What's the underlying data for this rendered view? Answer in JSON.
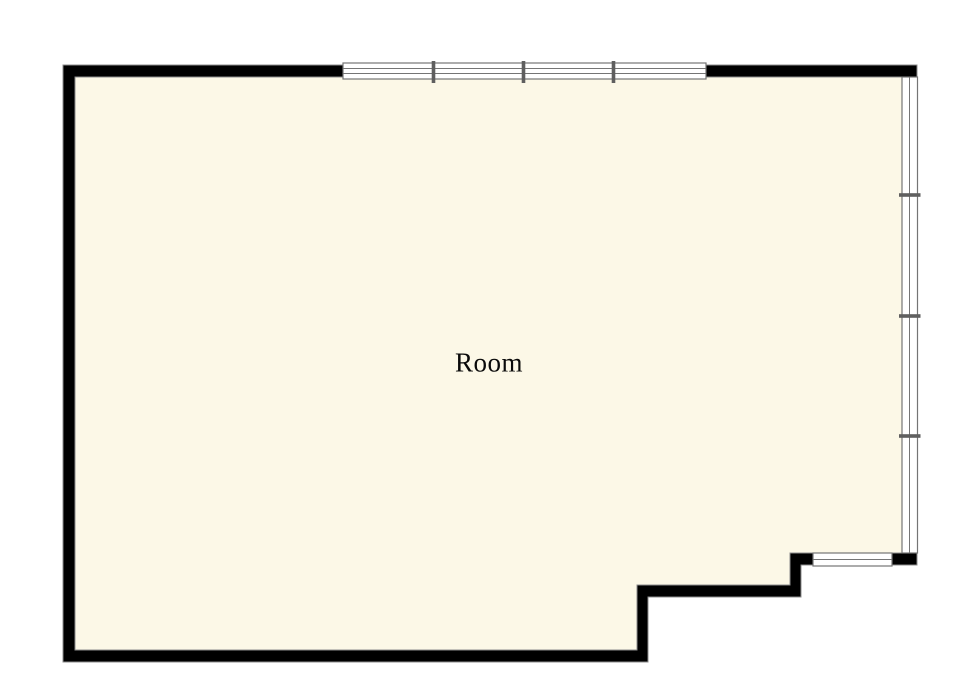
{
  "floorplan": {
    "room_label": "Room",
    "colors": {
      "background": "#ffffff",
      "floor": "#fcf8e7",
      "wall": "#000000",
      "wall_outline": "#8c8c8c",
      "window_fill": "#ffffff",
      "window_frame": "#757575",
      "window_mullion": "#5f5f5f",
      "label_text": "#0a0a0a"
    },
    "windows": [
      {
        "name": "top-window",
        "orientation": "horizontal",
        "panes": 4
      },
      {
        "name": "right-window",
        "orientation": "vertical",
        "panes": 4
      },
      {
        "name": "bottom-right-window",
        "orientation": "horizontal",
        "panes": 1
      }
    ]
  }
}
